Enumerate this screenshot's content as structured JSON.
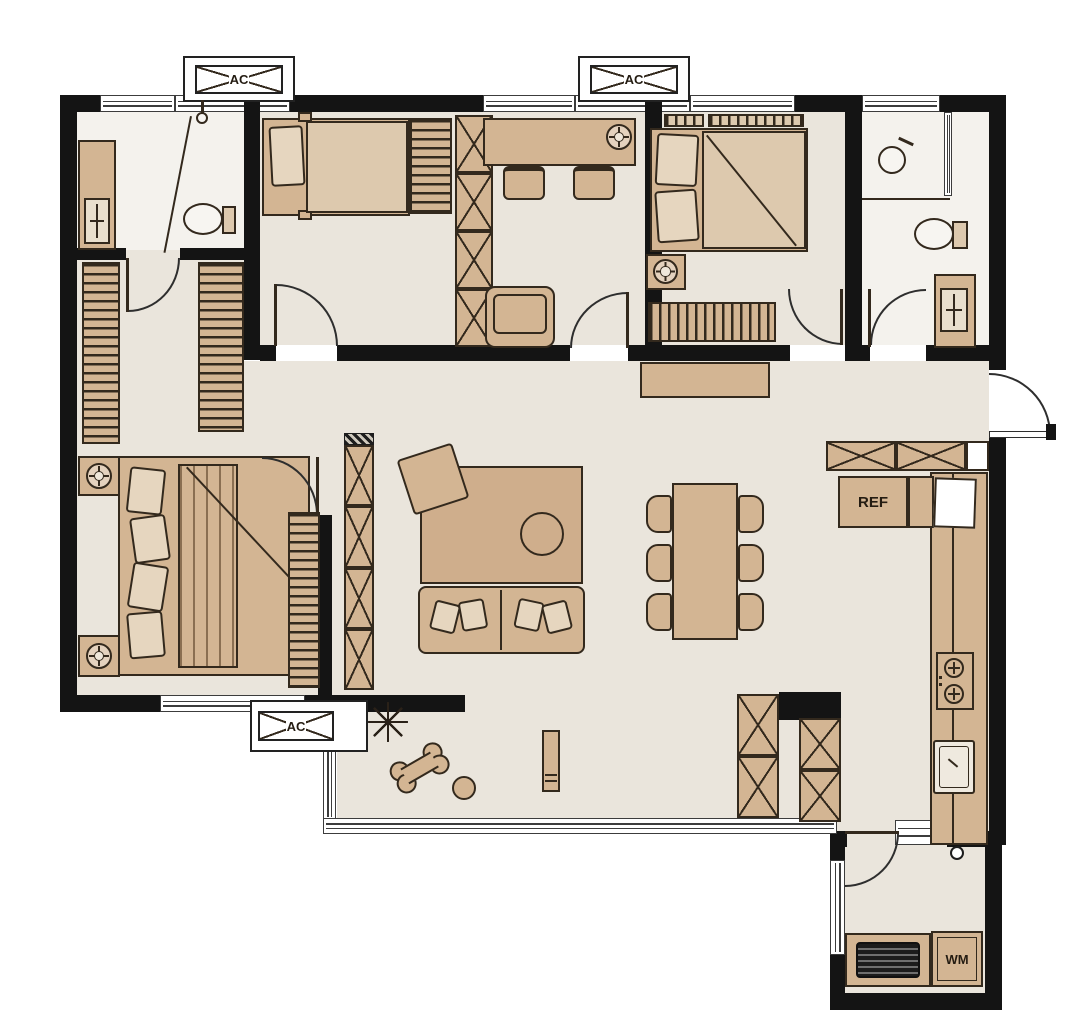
{
  "scene": {
    "kind": "apartment-floor-plan",
    "width_px": 1080,
    "height_px": 1013
  },
  "colors": {
    "wall": "#141414",
    "floor": "#eae5dc",
    "bathroom_floor": "#f4f2ed",
    "furniture": "#d3b593",
    "furniture_light": "#ddc9ae",
    "outline": "#33291d",
    "rug": "#cfae8c",
    "background": "#ffffff"
  },
  "ac_platforms": [
    {
      "id": "top-left",
      "label": "AC"
    },
    {
      "id": "top-right",
      "label": "AC"
    },
    {
      "id": "bottom-left",
      "label": "AC"
    }
  ],
  "appliances": {
    "refrigerator": {
      "label": "REF"
    },
    "washing_machine": {
      "label": "WM"
    }
  },
  "icons": [
    "ac-platform-icon",
    "toilet-icon",
    "sink-icon",
    "shower-icon",
    "faucet-icon",
    "bed-icon",
    "pillow-icon",
    "wardrobe-hanging-icon",
    "cabinet-x-icon",
    "desk-icon",
    "desk-chair-icon",
    "armchair-icon",
    "ceiling-lamp-icon",
    "sofa-icon",
    "rug-icon",
    "coffee-table-icon",
    "floor-cushion-icon",
    "dining-table-icon",
    "dining-chair-icon",
    "refrigerator-icon",
    "stove-icon",
    "kitchen-sink-icon",
    "washing-machine-icon",
    "radiator-icon",
    "snowflake-icon",
    "dog-bone-toy-icon",
    "ball-icon",
    "floor-drain-icon",
    "door-swing-icon",
    "window-icon",
    "blinds-icon"
  ]
}
